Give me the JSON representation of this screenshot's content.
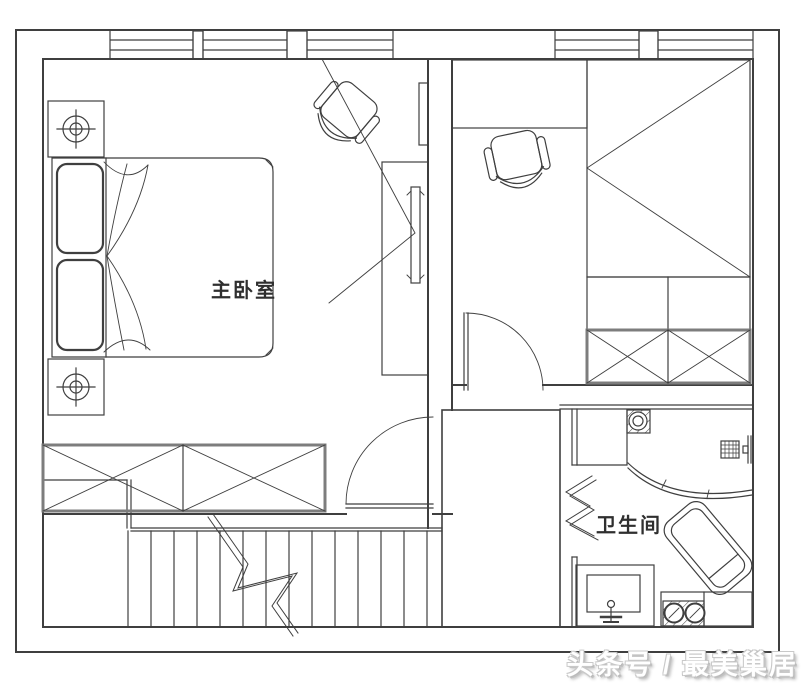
{
  "page": {
    "background": "#ffffff"
  },
  "plan": {
    "labels": {
      "master_bedroom": "主卧室",
      "bathroom": "卫生间"
    },
    "watermark": {
      "text": "头条号 / 最美巢居"
    },
    "colors": {
      "line": "#3f3f3f",
      "furniture_accent": "#7d7d7d",
      "watermark_fill": "#ffffff",
      "watermark_outline": "#c2c2c2",
      "background": "#ffffff"
    },
    "icon_elements": [
      "outer-wall",
      "window",
      "mullion",
      "master-bedroom",
      "double-bed",
      "pillow",
      "nightstand",
      "lamp-symbol",
      "tv-cabinet",
      "tv",
      "wardrobe-x-cabinet",
      "office-chair",
      "second-bedroom",
      "desk",
      "single-bed",
      "dresser",
      "stairs",
      "stair-break-line",
      "closet-shaft",
      "bathroom",
      "toilet",
      "shower-screen",
      "shower-mixer",
      "bathtub",
      "vanity-sink",
      "faucet",
      "laundry-basins",
      "door-arc",
      "wall-opening-zigzag"
    ]
  }
}
